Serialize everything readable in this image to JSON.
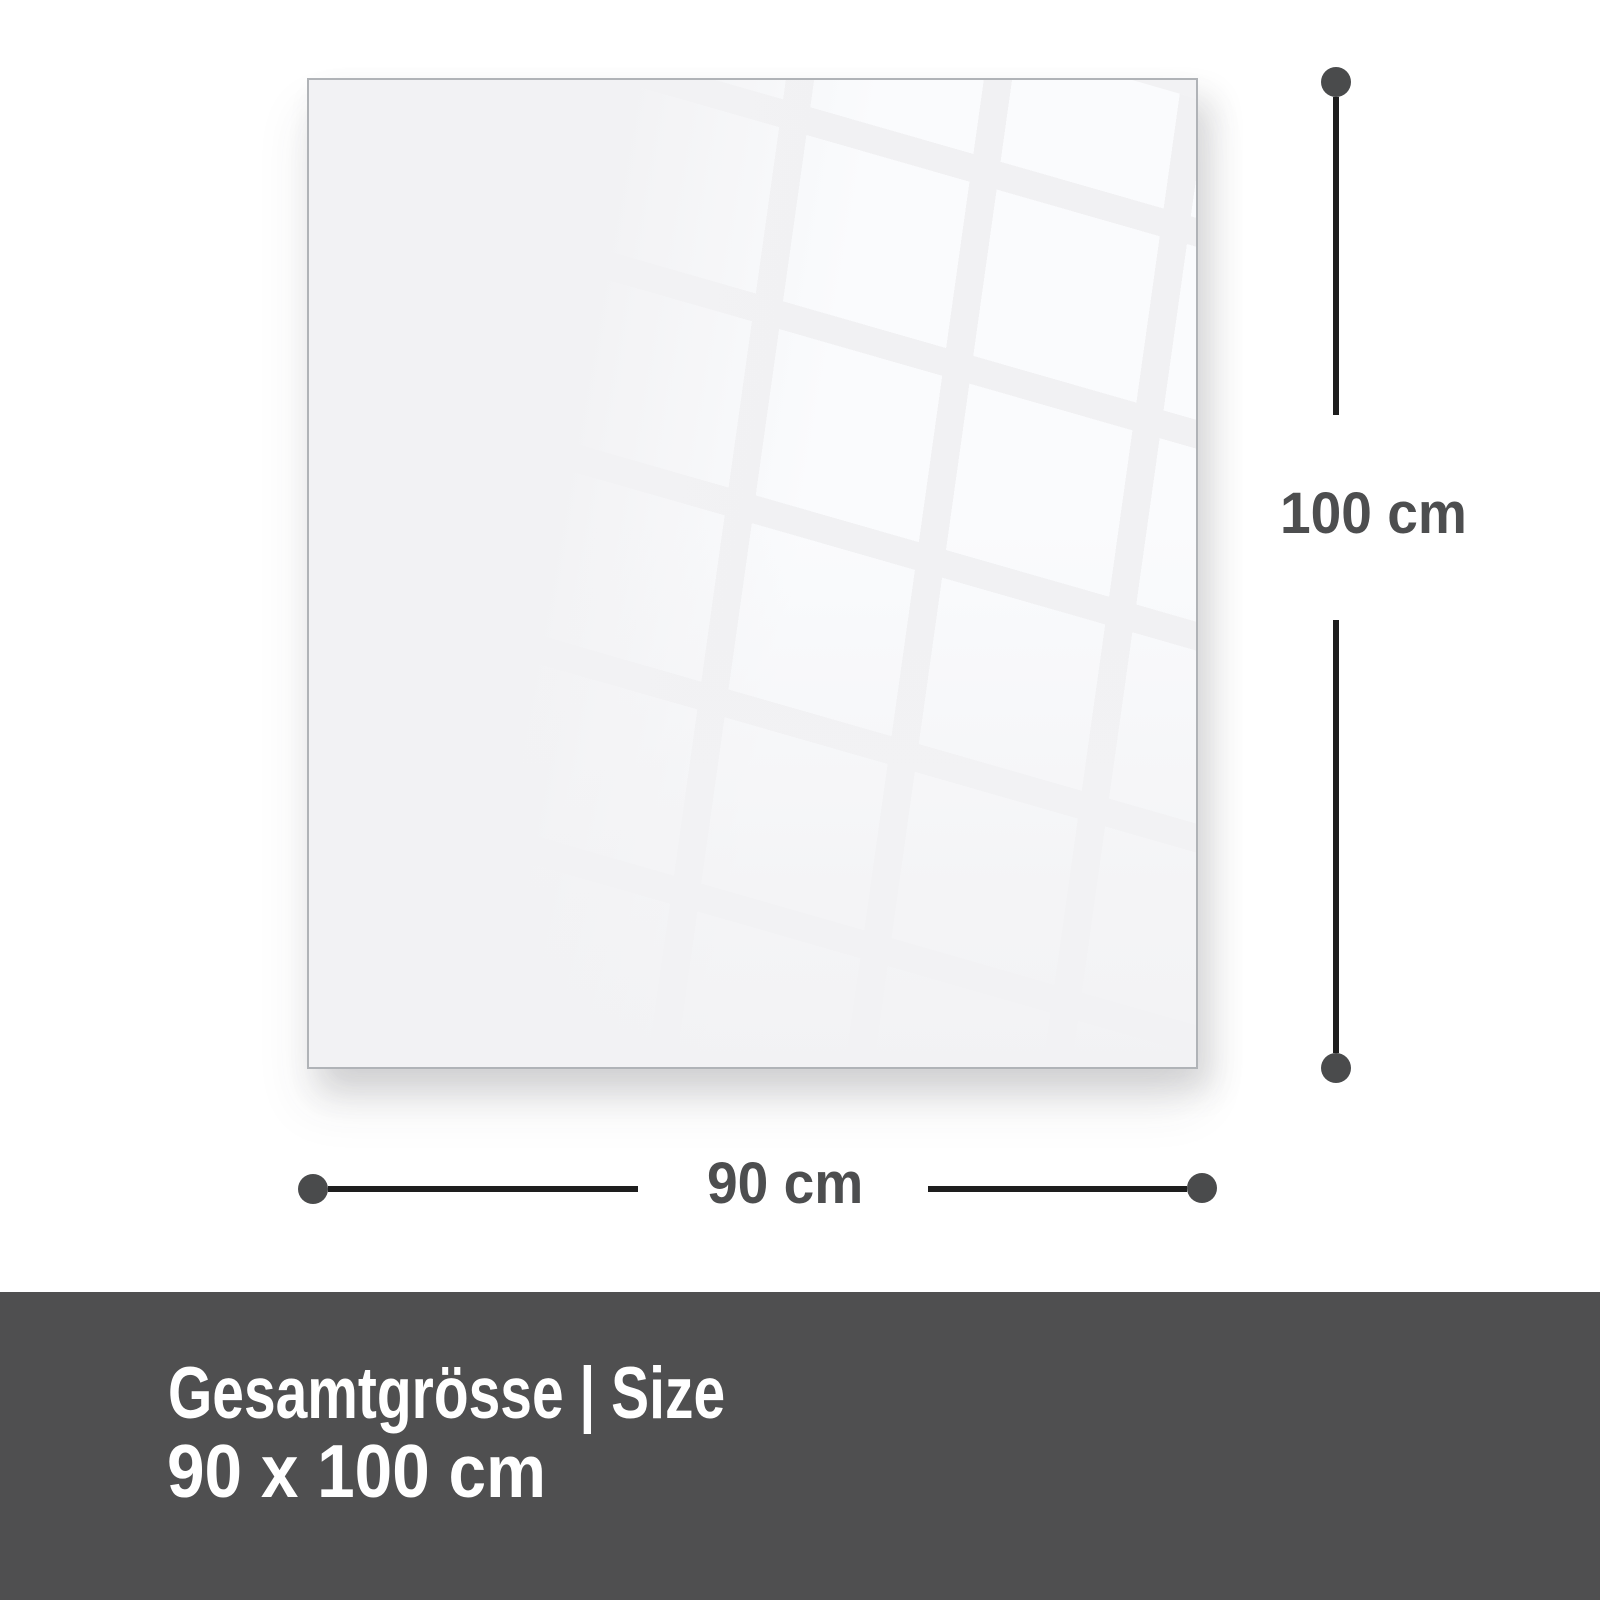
{
  "diagram": {
    "panel_width_cm": 90,
    "panel_height_cm": 100,
    "height_label": "100 cm",
    "width_label": "90 cm"
  },
  "footer": {
    "heading": "Gesamtgrösse | Size",
    "size": "90 x 100 cm"
  },
  "colors": {
    "page_background": "#ffffff",
    "panel_fill": "#f2f2f4",
    "panel_border": "#b0b3b7",
    "reflection_highlight": "#fafbfd",
    "dimension_line": "#1e1e1e",
    "dimension_dot": "#4a4b4c",
    "dimension_text": "#4d4e4f",
    "footer_background": "#4f4f50",
    "footer_text": "#ffffff"
  }
}
